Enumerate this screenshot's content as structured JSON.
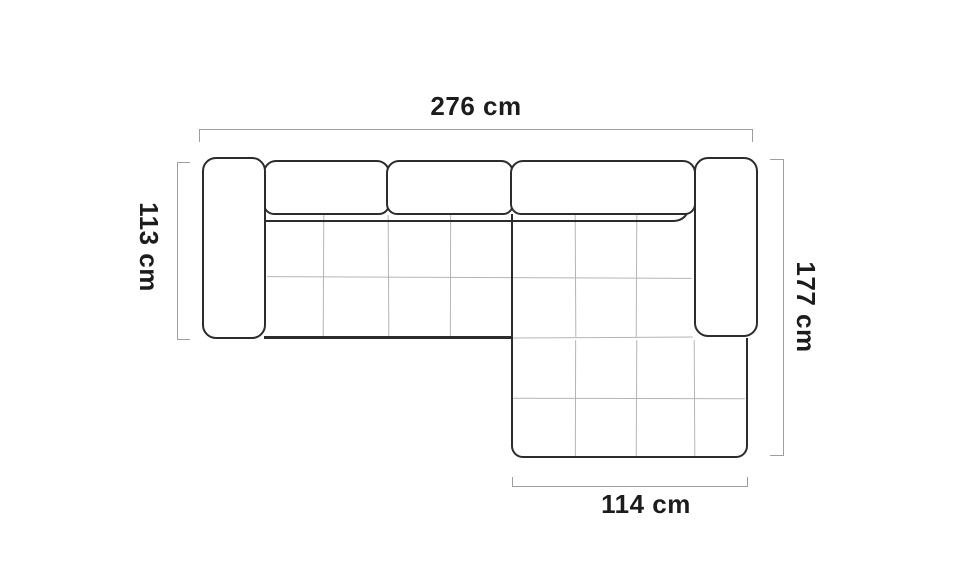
{
  "diagram": {
    "type": "furniture-dimension-drawing",
    "subject": "corner-sofa-top-view",
    "dimensions": {
      "top": {
        "label": "276 cm",
        "side": "top"
      },
      "left": {
        "label": "113 cm",
        "side": "left"
      },
      "right": {
        "label": "177 cm",
        "side": "right"
      },
      "bottom": {
        "label": "114 cm",
        "side": "bottom"
      }
    },
    "colors": {
      "background": "#ffffff",
      "outline": "#2c2c2c",
      "stitch_line": "#b4b4b4",
      "dimension_line": "#9e9e9e",
      "label_text": "#1c1c1c"
    }
  }
}
